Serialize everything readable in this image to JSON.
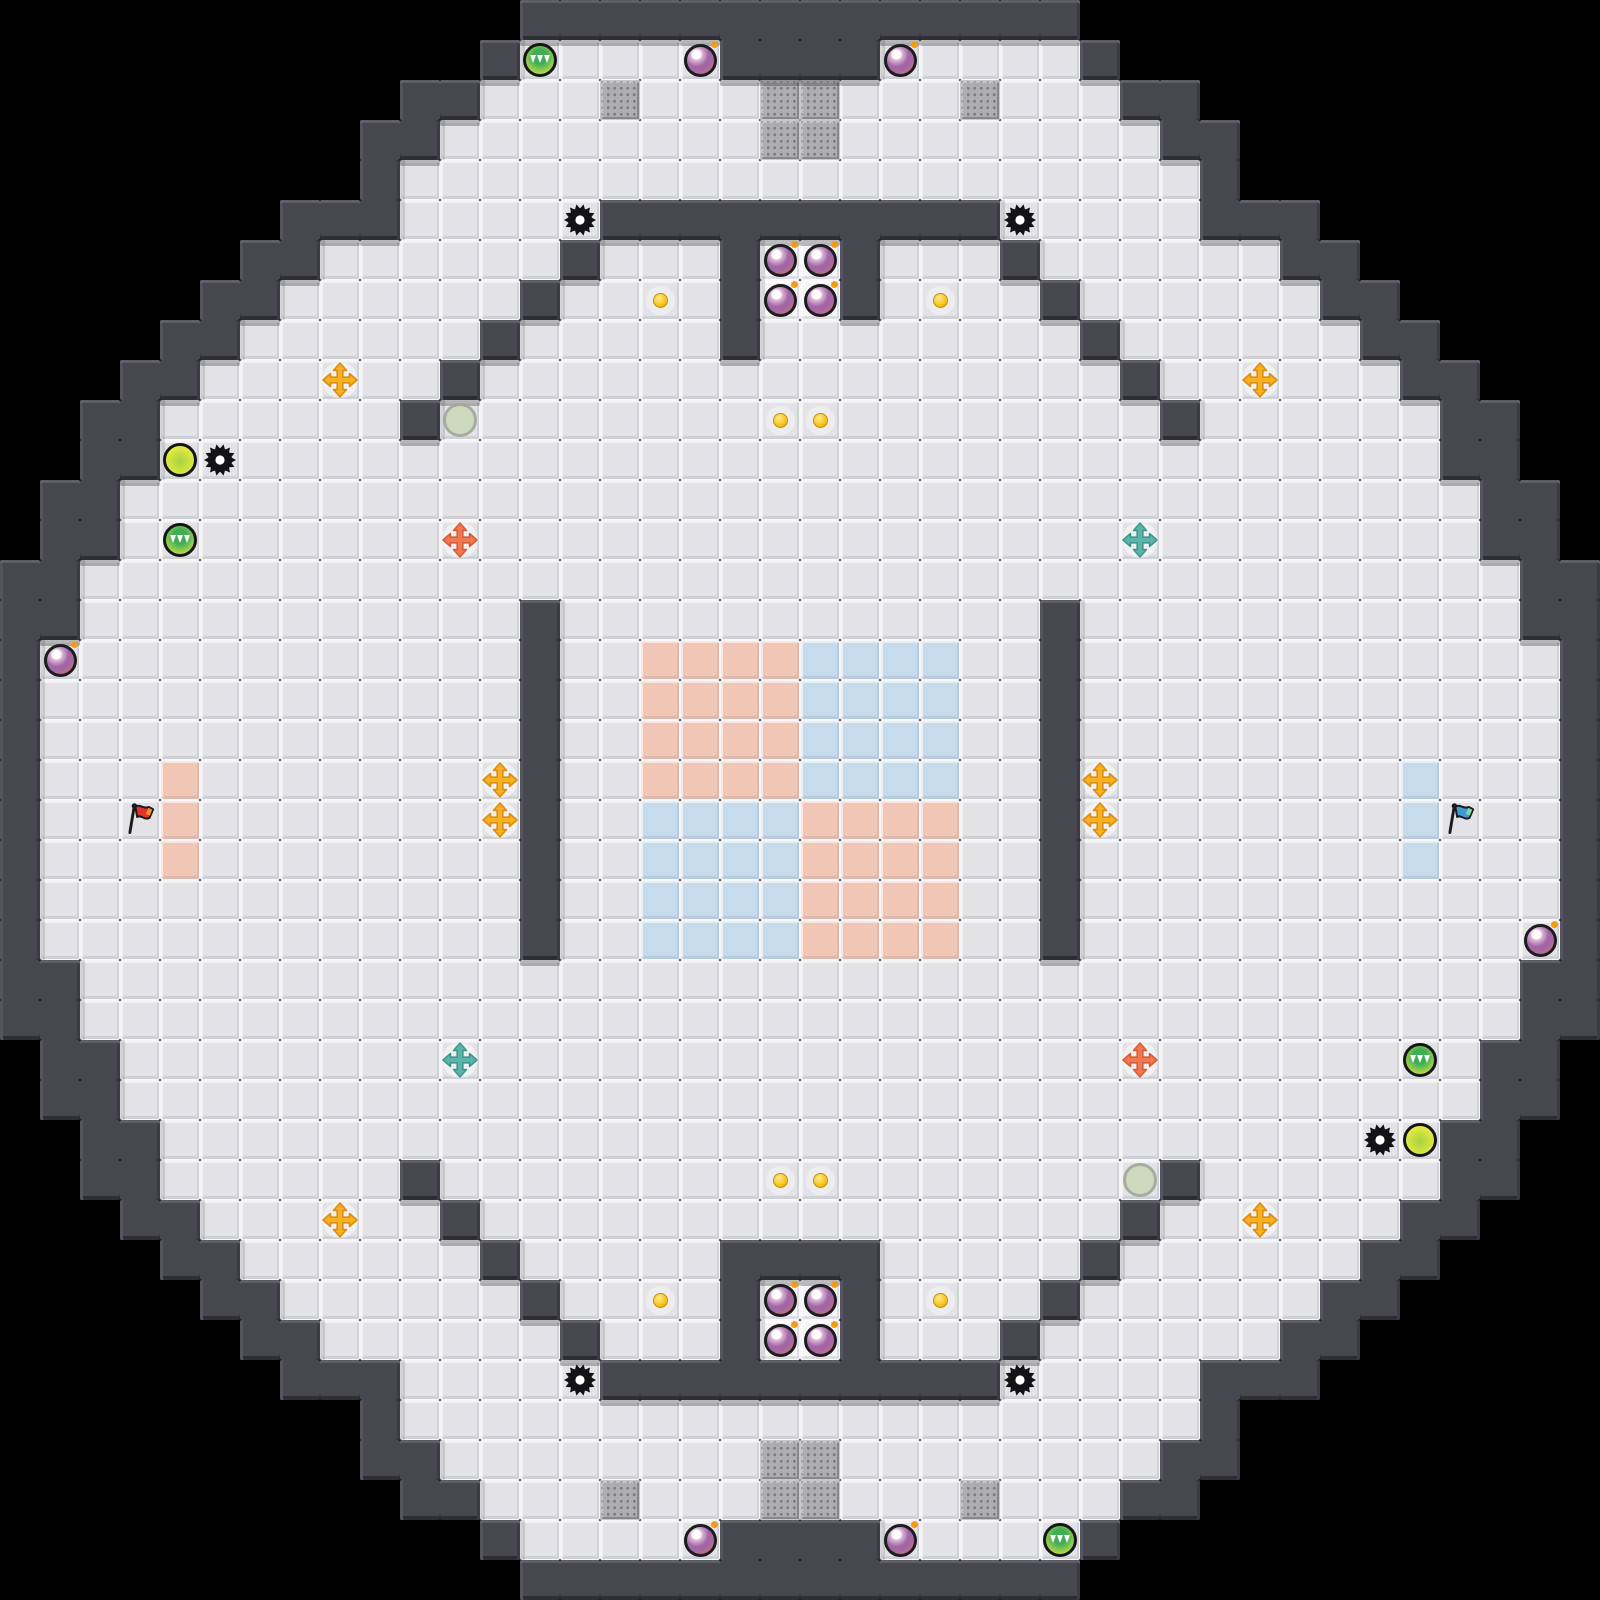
{
  "scene": "octagonal-ctf-tile-map",
  "board": {
    "tile_size": 40,
    "cols": 40,
    "rows": 40,
    "legend": {
      " ": "background",
      "#": "wall",
      ".": "floor",
      "W": "bright-floor",
      "G": "gate",
      "R": "red-team-tile",
      "B": "blue-team-tile"
    },
    "grid": [
      "             ##############             ",
      "            #.....####.....#            ",
      "          ##...G...GG...G...##          ",
      "         ##........GG........##         ",
      "         #....................#         ",
      "       ###.....##########.....###       ",
      "      ##......#...#WW#...#......##      ",
      "     ##......#....#WW#....#......##     ",
      "    ##......#.....#........#......##    ",
      "   ##......#................#......##   ",
      "  ##......#..................#......##  ",
      "  ##................................##  ",
      " ##..................................## ",
      " ##..................................## ",
      "##....................................##",
      "##...........#............#...........##",
      "#............#..RRRRBBBB..#............#",
      "#............#..RRRRBBBB..#............#",
      "#............#..RRRRBBBB..#............#",
      "#...R........#..RRRRBBBB..#........B...#",
      "#...R........#..BBBBRRRR..#........B...#",
      "#...R........#..BBBBRRRR..#........B...#",
      "#............#..BBBBRRRR..#............#",
      "#............#..BBBBRRRR..#............#",
      "##....................................##",
      "##....................................##",
      " ##..................................## ",
      " ##..................................## ",
      "  ##................................##  ",
      "  ##......#..................#......##  ",
      "   ##......#................#......##   ",
      "    ##......#.....####.....#......##    ",
      "     ##......#....#WW#....#......##     ",
      "      ##......#...#WW#...#......##      ",
      "       ###.....##########.....###       ",
      "         #....................#         ",
      "         ##........GG........##         ",
      "          ##...G...GG...G...##          ",
      "            #.....####.....#            ",
      "             ##############             "
    ]
  },
  "objects": [
    {
      "type": "powerup-green",
      "x": 13,
      "y": 1
    },
    {
      "type": "bomb",
      "x": 17,
      "y": 1
    },
    {
      "type": "bomb",
      "x": 22,
      "y": 1
    },
    {
      "type": "spike",
      "x": 14,
      "y": 5
    },
    {
      "type": "spike",
      "x": 25,
      "y": 5
    },
    {
      "type": "bomb",
      "x": 19,
      "y": 6
    },
    {
      "type": "bomb",
      "x": 20,
      "y": 6
    },
    {
      "type": "bomb",
      "x": 19,
      "y": 7
    },
    {
      "type": "bomb",
      "x": 20,
      "y": 7
    },
    {
      "type": "dot",
      "x": 16,
      "y": 7
    },
    {
      "type": "dot",
      "x": 23,
      "y": 7
    },
    {
      "type": "boost-yellow",
      "x": 8,
      "y": 9
    },
    {
      "type": "boost-yellow",
      "x": 31,
      "y": 9
    },
    {
      "type": "spawn",
      "x": 11,
      "y": 10
    },
    {
      "type": "dot",
      "x": 19,
      "y": 10
    },
    {
      "type": "dot",
      "x": 20,
      "y": 10
    },
    {
      "type": "powerup-yellow",
      "x": 4,
      "y": 11
    },
    {
      "type": "spike",
      "x": 5,
      "y": 11
    },
    {
      "type": "powerup-green",
      "x": 4,
      "y": 13
    },
    {
      "type": "boost-red",
      "x": 11,
      "y": 13
    },
    {
      "type": "boost-blue",
      "x": 28,
      "y": 13
    },
    {
      "type": "bomb",
      "x": 1,
      "y": 16
    },
    {
      "type": "boost-yellow",
      "x": 12,
      "y": 19
    },
    {
      "type": "boost-yellow",
      "x": 12,
      "y": 20
    },
    {
      "type": "boost-yellow",
      "x": 27,
      "y": 19
    },
    {
      "type": "boost-yellow",
      "x": 27,
      "y": 20
    },
    {
      "type": "flag-red",
      "x": 3,
      "y": 20
    },
    {
      "type": "flag-blue",
      "x": 36,
      "y": 20
    },
    {
      "type": "bomb",
      "x": 38,
      "y": 23
    },
    {
      "type": "boost-blue",
      "x": 11,
      "y": 26
    },
    {
      "type": "boost-red",
      "x": 28,
      "y": 26
    },
    {
      "type": "powerup-green",
      "x": 35,
      "y": 26
    },
    {
      "type": "spike",
      "x": 34,
      "y": 28
    },
    {
      "type": "powerup-yellow",
      "x": 35,
      "y": 28
    },
    {
      "type": "spawn",
      "x": 28,
      "y": 29
    },
    {
      "type": "dot",
      "x": 19,
      "y": 29
    },
    {
      "type": "dot",
      "x": 20,
      "y": 29
    },
    {
      "type": "boost-yellow",
      "x": 8,
      "y": 30
    },
    {
      "type": "boost-yellow",
      "x": 31,
      "y": 30
    },
    {
      "type": "bomb",
      "x": 19,
      "y": 32
    },
    {
      "type": "bomb",
      "x": 20,
      "y": 32
    },
    {
      "type": "bomb",
      "x": 19,
      "y": 33
    },
    {
      "type": "bomb",
      "x": 20,
      "y": 33
    },
    {
      "type": "dot",
      "x": 16,
      "y": 32
    },
    {
      "type": "dot",
      "x": 23,
      "y": 32
    },
    {
      "type": "spike",
      "x": 14,
      "y": 34
    },
    {
      "type": "spike",
      "x": 25,
      "y": 34
    },
    {
      "type": "bomb",
      "x": 17,
      "y": 38
    },
    {
      "type": "bomb",
      "x": 22,
      "y": 38
    },
    {
      "type": "powerup-green",
      "x": 26,
      "y": 38
    }
  ],
  "colors": {
    "background": "#000000",
    "wall": "#47474f",
    "wall_light": "#5e5e67",
    "wall_edge_left": "#54545d",
    "wall_edge_right": "#3b3b42",
    "wall_edge_bottom": "#2e2e35",
    "wall_shadow": "rgba(24,24,32,0.28)",
    "wall_side_shadow": "rgba(24,24,32,0.14)",
    "floor": "#e3e3e7",
    "floor_bright": "#f5f5f7",
    "grout": "#f7f7f9",
    "gate": "#aeaeb1",
    "gate_dot": "#7c7c80",
    "team_red_tile": "#f1c6b4",
    "team_blue_tile": "#c6dcec",
    "bomb_ring": "#1d1d20",
    "bomb_highlight": "#ffffff",
    "bomb_mid": "#a266a4",
    "bomb_low": "#c8707c",
    "bomb_fuse": "#f29b1d",
    "spike": "#131317",
    "powerup_ring": "#161618",
    "grip_center": "#3fae57",
    "grip_edge": "#dfe94a",
    "grip_marks": "#ffffff",
    "yellow_center": "#a8d246",
    "yellow_edge": "#eef04b",
    "spawn_fill": "#cdd8ba",
    "spawn_ring": "#a2a89a",
    "dot_fill": "#f7c71f",
    "dot_edge": "#d89d0d",
    "boost_yellow": "#f5b120",
    "boost_yellow_dark": "#dd8c12",
    "boost_red": "#ef7951",
    "boost_red_dark": "#da5c36",
    "boost_blue": "#5cb5ab",
    "boost_blue_dark": "#3f968c",
    "halo": "rgba(255,255,255,0.5)",
    "flag_pole": "#1b1b1e",
    "flag_red": "#e63329",
    "flag_red_tip": "#f7941d",
    "flag_blue": "#3f9cd3",
    "flag_blue_tip": "#7fd6a6"
  }
}
